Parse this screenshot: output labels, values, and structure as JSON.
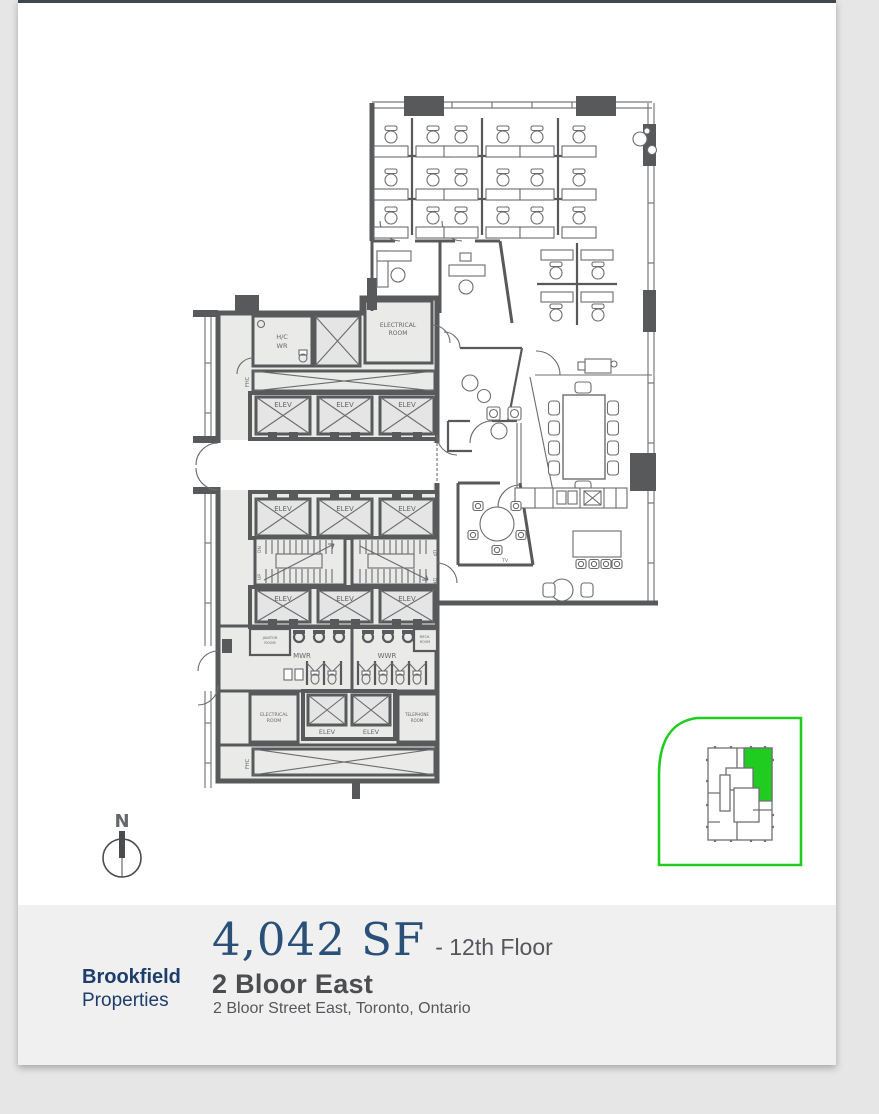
{
  "page": {
    "background": "#e6e6e6",
    "paper": "#ffffff",
    "top_bar_color": "#40484f"
  },
  "plan": {
    "wall_color": "#58595b",
    "room_fill": "#eaeae9",
    "labels": {
      "elev": "ELEV",
      "electrical": "ELECTRICAL",
      "room": "ROOM",
      "telephone": "TELEPHONE",
      "hc": "H/C",
      "wr": "WR",
      "mwr": "MWR",
      "wwr": "WWR",
      "janitor": "JANITOR",
      "mech": "MECH.",
      "fhc": "FHC",
      "dn": "DN",
      "up": "UP",
      "tv": "TV"
    }
  },
  "compass": {
    "north_label": "N"
  },
  "keyplan": {
    "accent_green": "#1fcc1f"
  },
  "footer": {
    "background": "#f0f0f1",
    "company_name": "Brookfield",
    "company_suffix": "Properties",
    "brand_color": "#1d3d6b",
    "area": "4,042 SF",
    "area_color": "#2a5078",
    "floor": "- 12th Floor",
    "building_name": "2 Bloor East",
    "address": "2 Bloor Street East, Toronto, Ontario"
  }
}
